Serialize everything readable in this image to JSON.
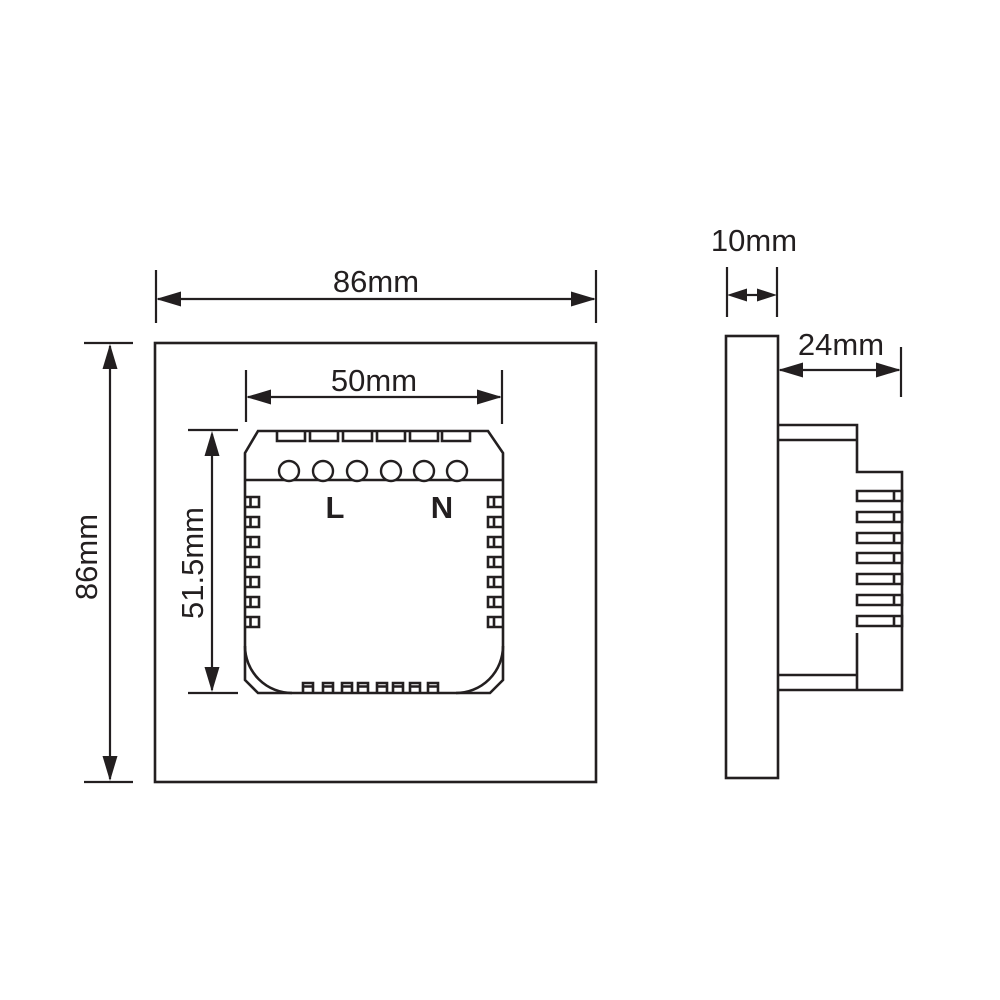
{
  "diagram": {
    "front_view": {
      "width_label": "86mm",
      "height_label": "86mm",
      "module_width_label": "50mm",
      "module_height_label": "51.5mm",
      "terminal_live_label": "L",
      "terminal_neutral_label": "N"
    },
    "side_view": {
      "panel_thickness_label": "10mm",
      "module_depth_label": "24mm"
    },
    "colors": {
      "line": "#231f20",
      "background": "#ffffff"
    }
  }
}
